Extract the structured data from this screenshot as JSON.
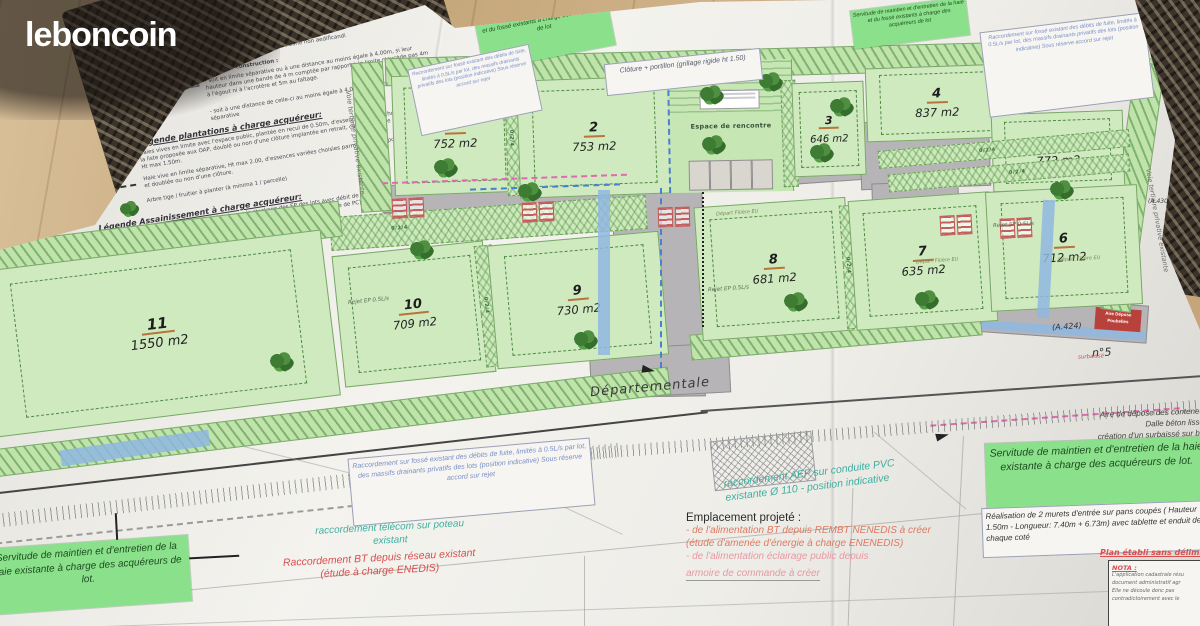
{
  "branding": {
    "logo_text": "leboncoin"
  },
  "colors": {
    "servitude_green": "#8be08b",
    "lot_green": "#cfeabf",
    "road_gray": "#b6b4b6",
    "teal_annotation": "#3fae9f",
    "red_annotation": "#d94f4f",
    "salmon_annotation": "#e8927c",
    "blue_note": "#7b8fc7",
    "pink_boundary": "#e06ab0",
    "water_blue": "#8fb7e0"
  },
  "legend": {
    "z1": "Z1: Zone de Construction à vocation à recevoir la construction principale",
    "z2": "Z2: Zone où les constructions sont interdites",
    "z3": "Z3: Zone où les constructions sont interdites avec servitude de maintien et d'entretien des haies et fossés existants",
    "recul_note": "Cote de recul en mètres dans une zone non aedificandi",
    "z4_title": "Z4 Zone de construction :",
    "z4_a": "- soit en limite séparative ou à une distance au moins égale à 4.00m, si leur hauteur dans une bande de 4 m comptée par rapport à la limite n'excède pas 4m à l'égout ni à l'acrotère et 5m au faîtage.",
    "z4_b": "- soit à une distance de celle-ci au moins égale à 4.00m par rapport à la limite séparative",
    "plantations_title": "Légende plantations à charge acquéreur:",
    "plantation_1": "Haies vives en limite avec l'espace public, plantée en recul de 0.50m, d'essences variées choisies parmi la liste proposée aux OAP, doublé ou non d'une clôture implantée en retrait, côté privatif de la parcelle - Ht max 1.50m.",
    "plantation_2": "Haie vive en limite séparative, Ht max 2.00, d'essences variées choisies parmi la liste proposée aux OAP et doublée ou non d'une clôture.",
    "plantation_3": "Arbre tige / fruitier à planter (à minima 1 / parcelle)",
    "assainissement_title": "Légende Assainissement à charge acquéreur:",
    "assainissement_1": "regard EP après massif drainant pour le stockage des EP des lots avec débit de fuite limité à 0.5L/s avant rejet ( position indicative sur fossé existant, à définir lors de la demande de PC)",
    "assainissement_2": "Boîte de branchement en attente de raccordement pour du débit de fuite ou des filières d'assainissement EU autonomes après traitement"
  },
  "lots": [
    {
      "num": "1",
      "area": "752 m2"
    },
    {
      "num": "2",
      "area": "753 m2"
    },
    {
      "num": "3",
      "area": "646 m2"
    },
    {
      "num": "4",
      "area": "837 m2"
    },
    {
      "num": "5",
      "area": "772 m2"
    },
    {
      "num": "6",
      "area": "712 m2"
    },
    {
      "num": "7",
      "area": "635 m2"
    },
    {
      "num": "8",
      "area": "681 m2"
    },
    {
      "num": "9",
      "area": "730 m2"
    },
    {
      "num": "10",
      "area": "709 m2"
    },
    {
      "num": "11",
      "area": "1550 m2"
    }
  ],
  "map": {
    "espace": "Espace de rencontre",
    "departementale": "Départementale",
    "n5": "n°5",
    "a423": "(A.423)",
    "a424": "(A.424)",
    "a430": "(A.430)",
    "voie_tertiaire": "Voie tertiaire privative existante",
    "spacing": "0/2/4",
    "rejet_ep": "Rejet EP 0.5L/s",
    "depart_filiere": "Départ Filière EU",
    "cloture": "Clôture + portillon (grillage rigide ht 1.50)",
    "poubelles": "Aire Dépose Poubelles",
    "surbaisse": "surbaissé"
  },
  "annotations": {
    "servitude_fosse": "Servitude de maintien et d'entretien de la haie et du fossé existants à charge des acquéreurs de lot",
    "servitude_haie": "Servitude de maintien et d'entretien de la haie existante à charge des acquéreurs de lot.",
    "raccordement_fosse": "Raccordement sur fossé existant des débits de fuite, limités à 0.5L/s par lot, des massifs drainants privatifs des lots (position indicative) Sous réserve accord sur rejet",
    "telecom": "raccordement télécom sur poteau existant",
    "bt": "Raccordement BT depuis réseau existant (étude à charge ENEDIS)",
    "aep": "raccordement AEP sur conduite PVC existante Ø 110 - position indicative",
    "emplacement_title": "Emplacement projeté :",
    "emplacement_1": "- de l'alimentation BT depuis REMBT NENEDIS à créer",
    "emplacement_2": "(étude d'amenée d'énergie à charge ENENEDIS)",
    "emplacement_3": "- de l'alimentation éclairage public depuis",
    "emplacement_4": "armoire de commande à créer",
    "aire_depose_1": "Aire de dépose des conteneurs",
    "aire_depose_2": "Dalle béton lissé +",
    "aire_depose_3": "création d'un surbaissé sur bord",
    "murets": "Réalisation de 2 murets d'entrée sur pans coupés ( Hauteur 1.50m - Longueur: 7.40m + 6.73m) avec tablette et enduit de chaque coté",
    "plan_etabli": "Plan établi sans délimitation",
    "nota_title": "NOTA :",
    "nota_1": "L'application cadastrale résu",
    "nota_2": "document administratif agr",
    "nota_3": "Elle ne découle donc pas",
    "nota_4": "contradictoirement avec le"
  }
}
